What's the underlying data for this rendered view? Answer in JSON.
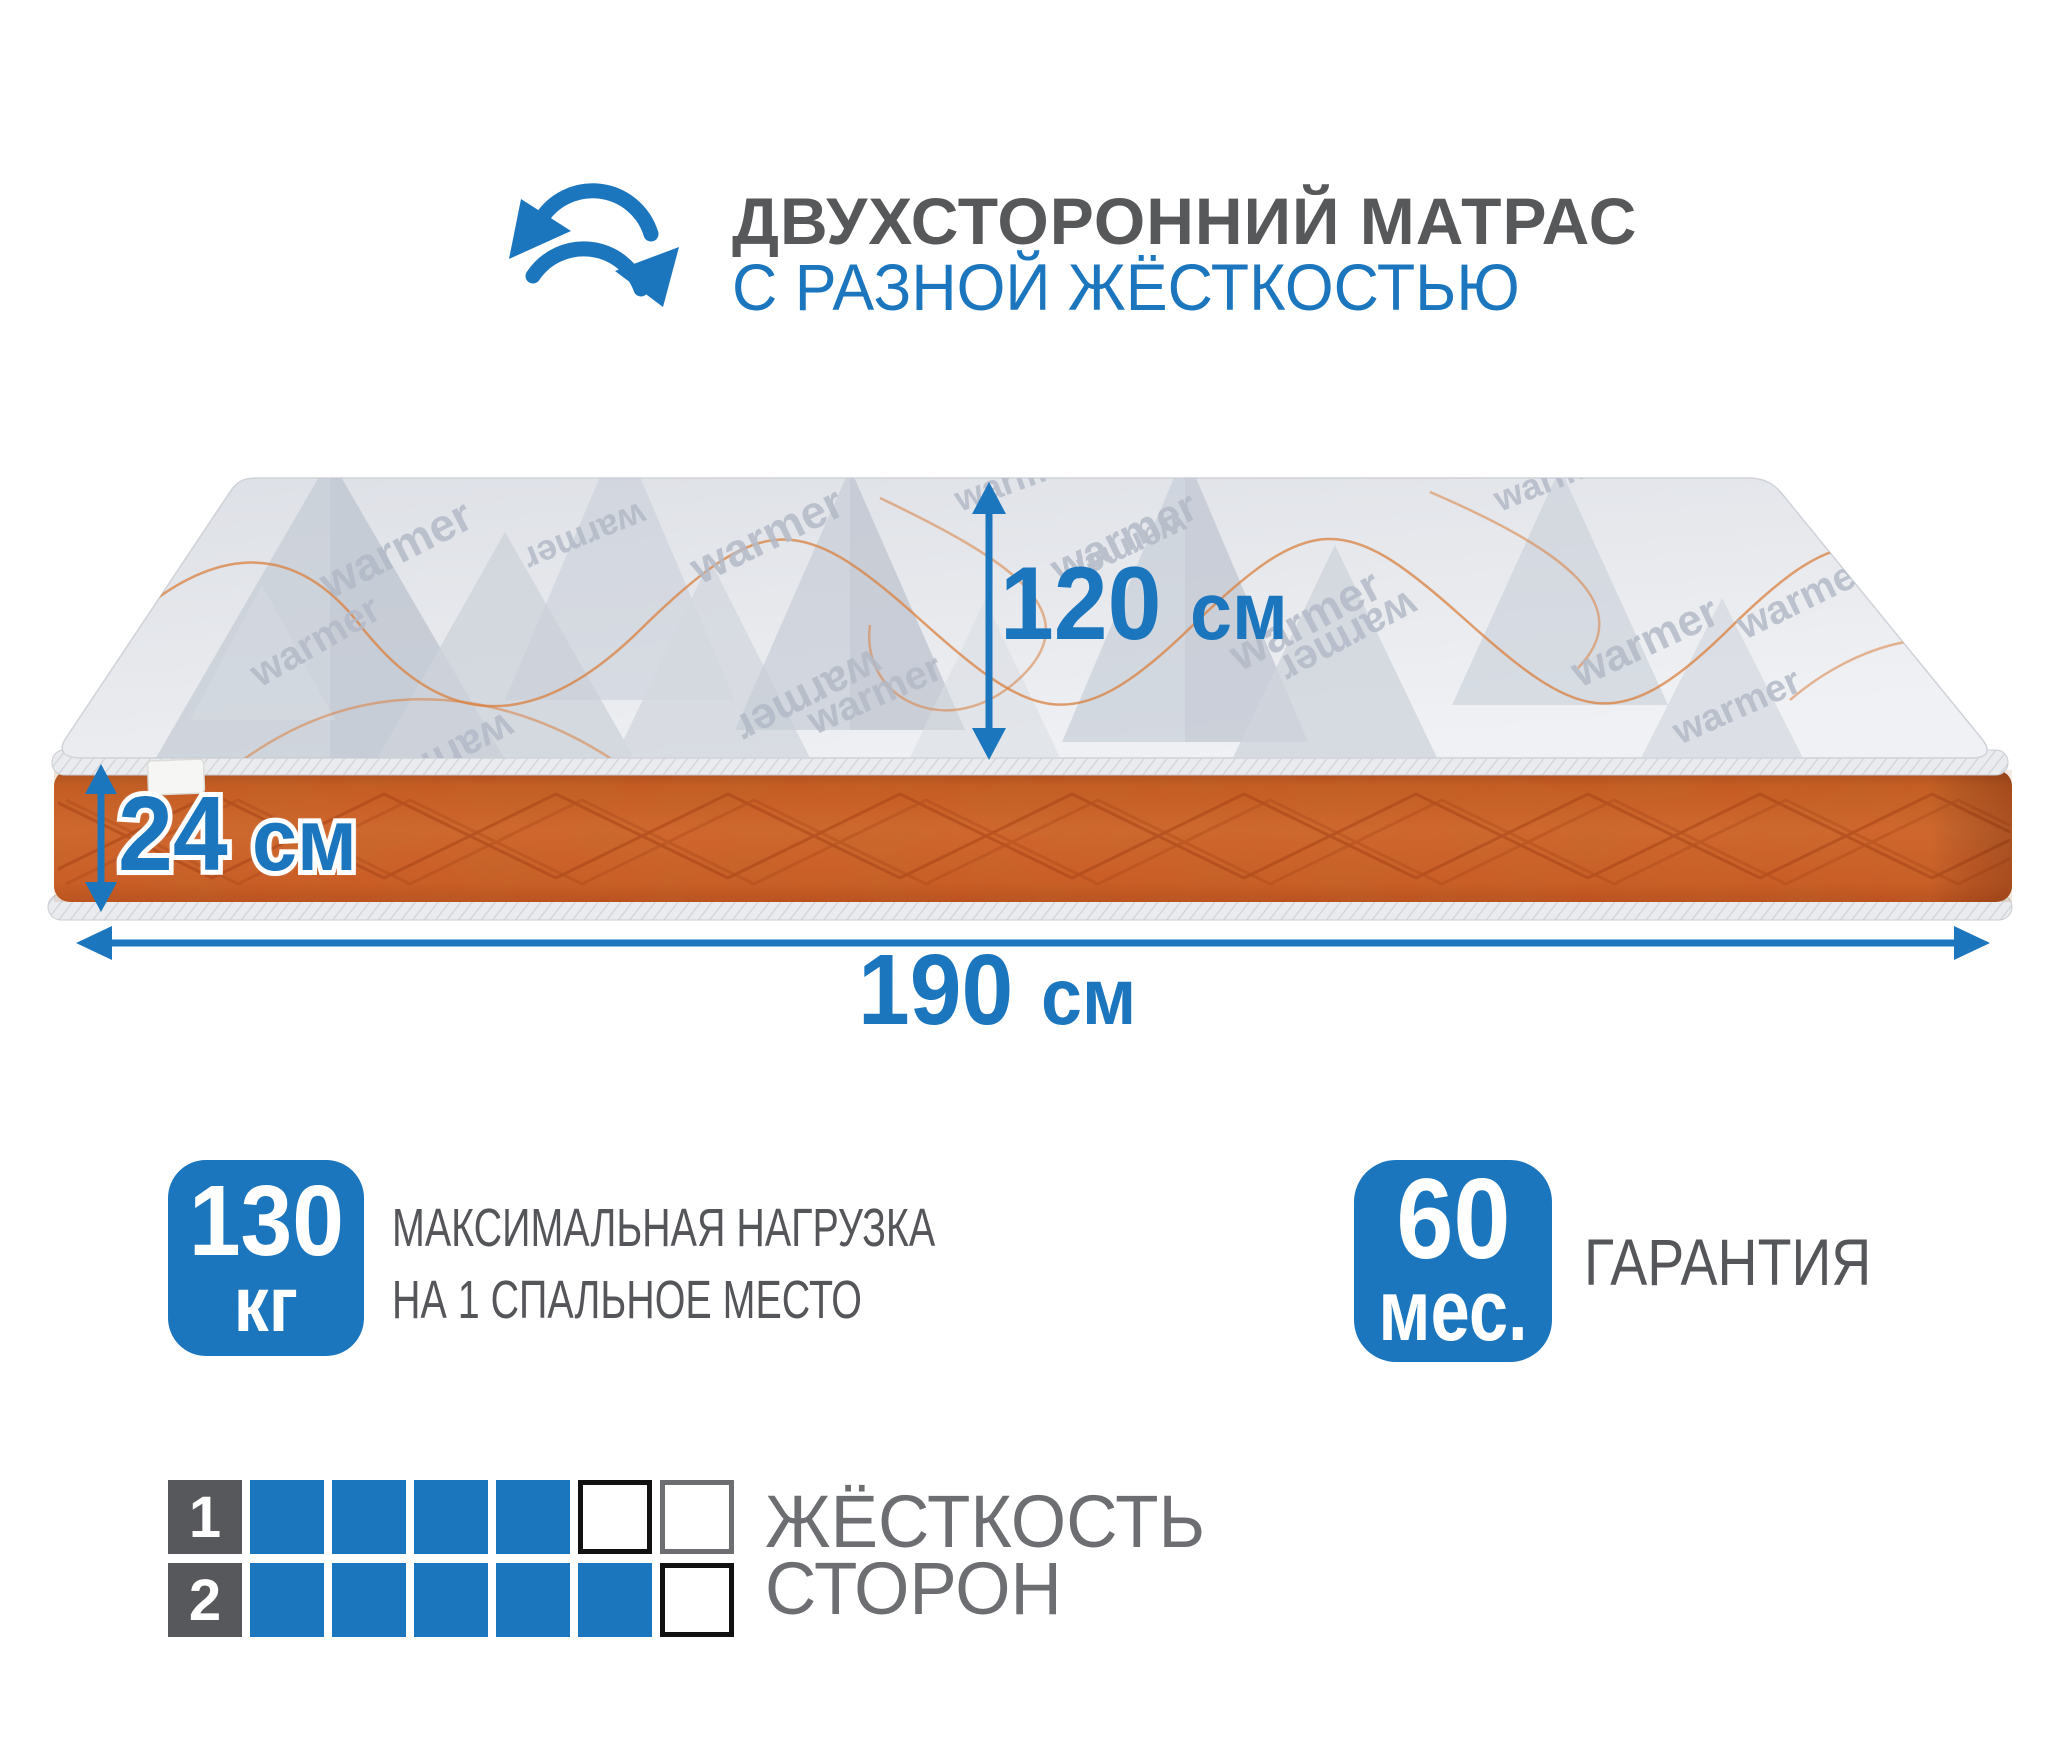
{
  "colors": {
    "accent_blue": "#1b76bd",
    "title_gray": "#57585a",
    "label_gray": "#55565a",
    "matrix_label_gray": "#6d6e71",
    "matrix_number_bg": "#57585b",
    "mattress_top_gray": "#e6e8ec",
    "mattress_side_orange": "#cd5e28",
    "stitch_orange": "#a64417",
    "piping_gray": "#e9ebee"
  },
  "header": {
    "title_line1": "ДВУХСТОРОННИЙ МАТРАС",
    "title_line2": "С РАЗНОЙ ЖЁСТКОСТЬЮ"
  },
  "mattress": {
    "fabric_text": "warmer"
  },
  "dimensions": {
    "depth": {
      "value": "120",
      "unit": "см"
    },
    "height": {
      "value": "24",
      "unit": "см"
    },
    "length": {
      "value": "190",
      "unit": "см"
    }
  },
  "features": {
    "max_load": {
      "value": "130",
      "unit": "кг",
      "label_line1": "МАКСИМАЛЬНАЯ НАГРУЗКА",
      "label_line2": "НА 1 СПАЛЬНОЕ МЕСТО"
    },
    "warranty": {
      "value": "60",
      "unit": "мес.",
      "label": "ГАРАНТИЯ"
    }
  },
  "firmness": {
    "label_line1": "ЖЁСТКОСТЬ",
    "label_line2": "СТОРОН",
    "scale_max": 6,
    "rows": [
      {
        "number": "1",
        "filled": 4,
        "cells": [
          "filled",
          "filled",
          "filled",
          "filled",
          "empty-black",
          "empty-gray"
        ]
      },
      {
        "number": "2",
        "filled": 5,
        "cells": [
          "filled",
          "filled",
          "filled",
          "filled",
          "filled",
          "empty-black"
        ]
      }
    ]
  }
}
